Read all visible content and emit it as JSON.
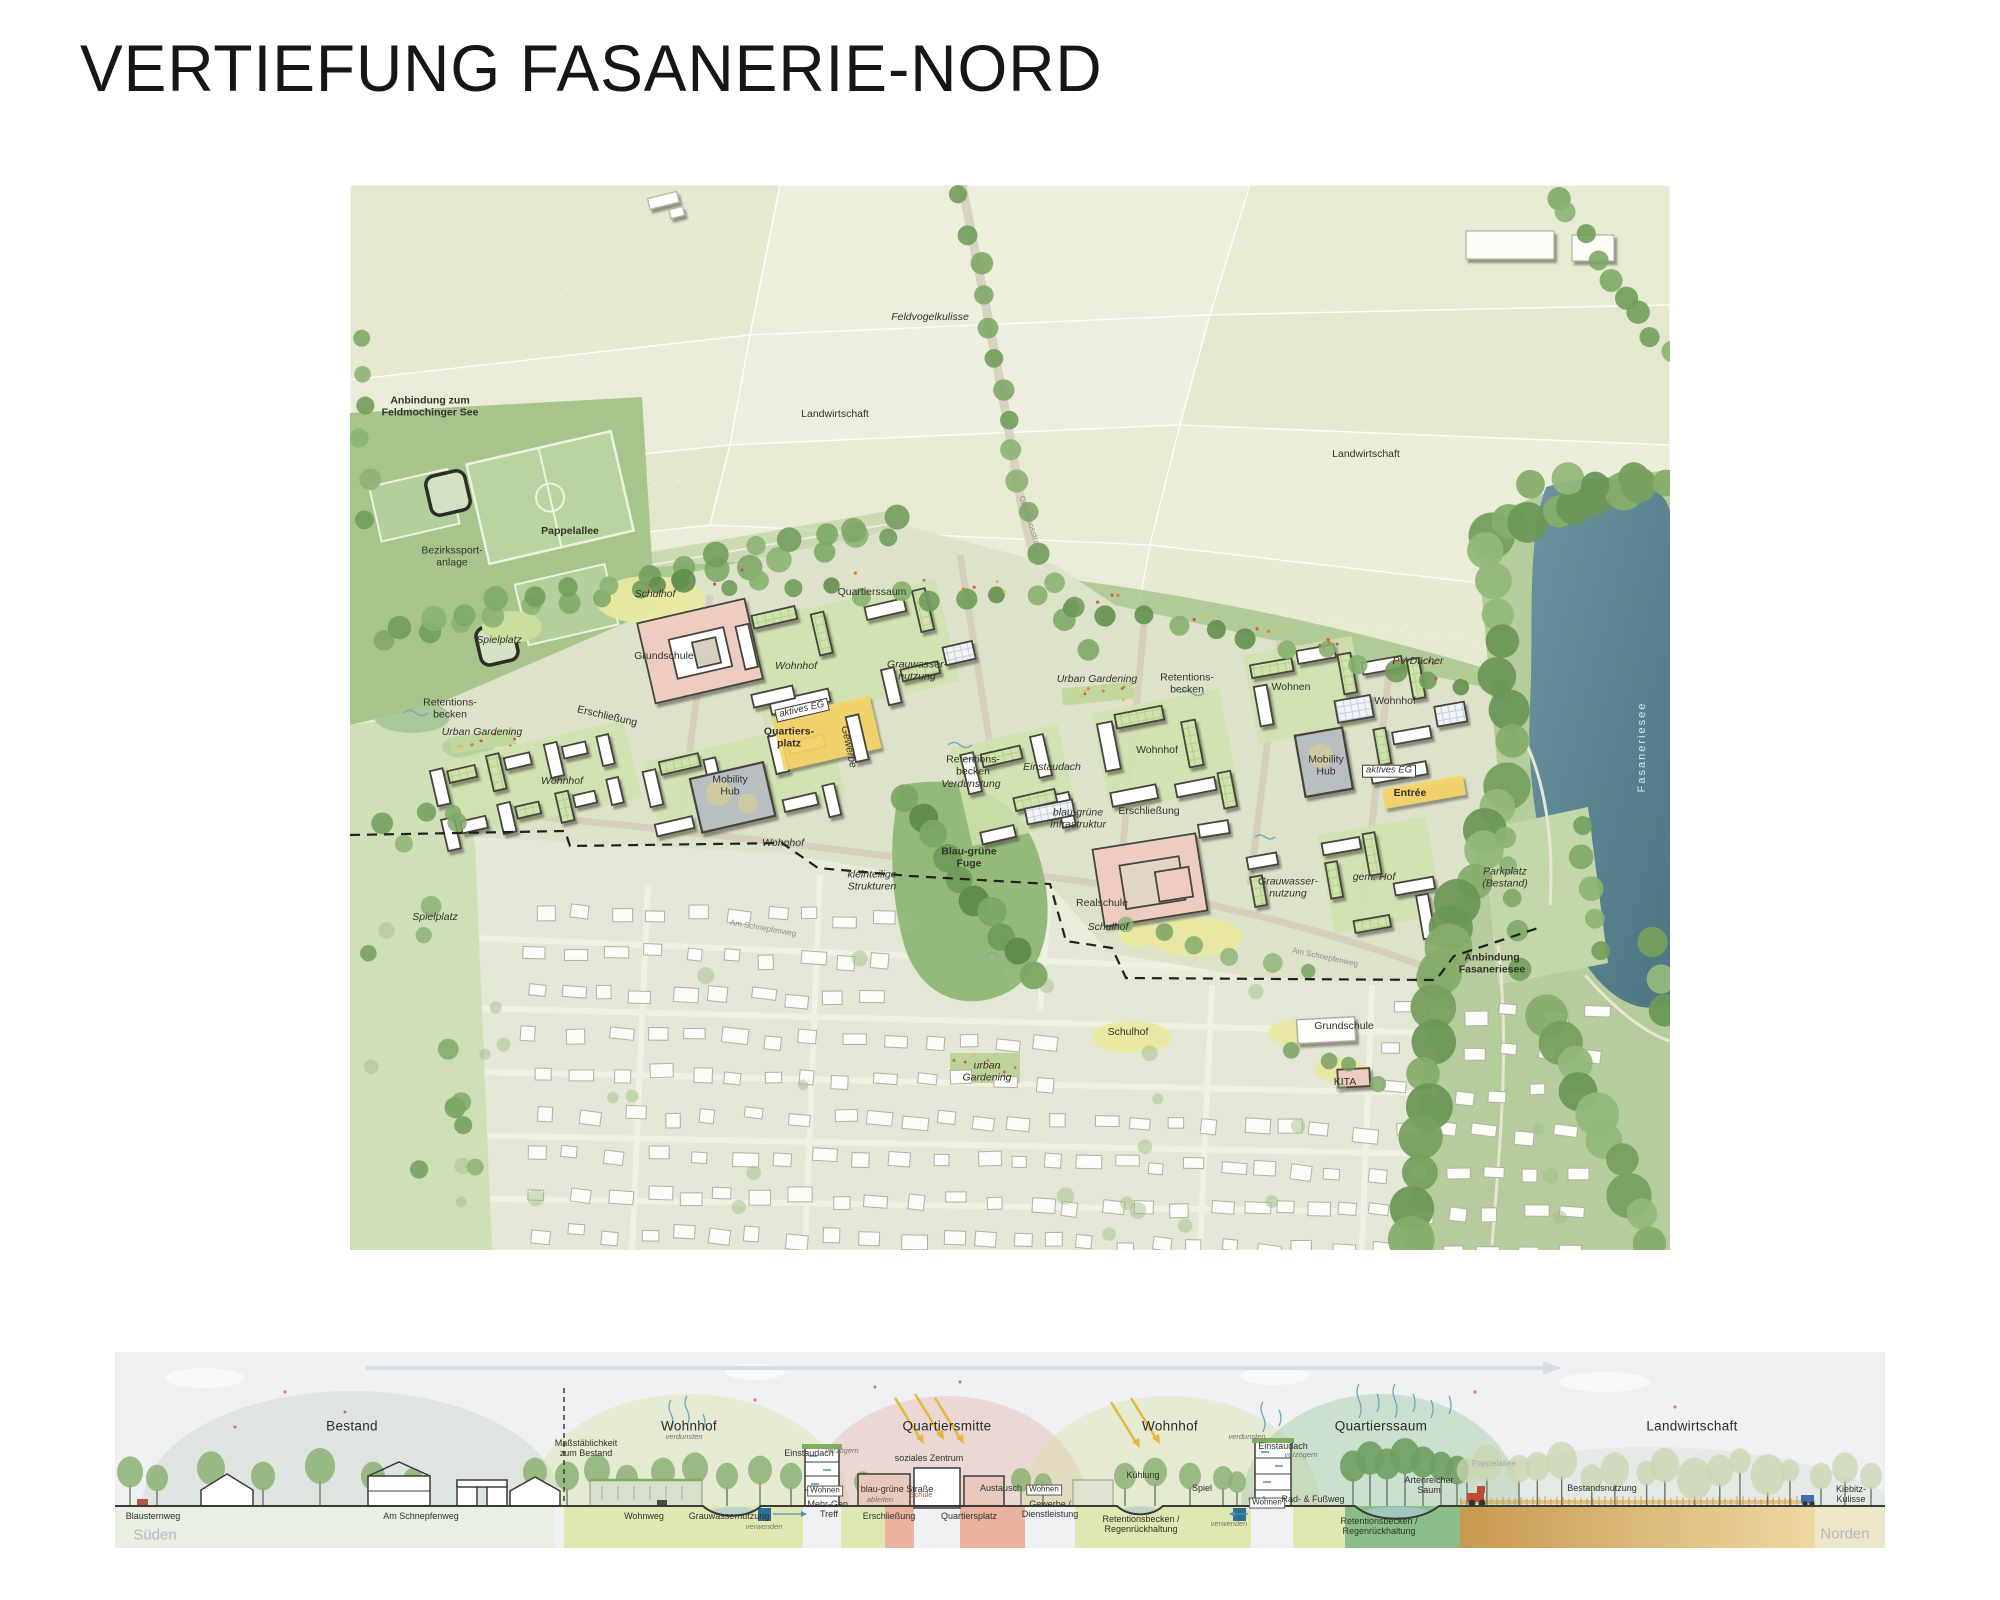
{
  "page": {
    "title": "VERTIEFUNG FASANERIE-NORD"
  },
  "colors": {
    "plaza_yellow": "#f5d469",
    "school_pink": "#efccc1",
    "lake_teal": "#597f8c",
    "mobility_gray": "#b8bfc3",
    "roof_green": "#cfe3ad",
    "field_green": "#e9ecd8",
    "boundary_black": "#21211d"
  },
  "map": {
    "labels": [
      {
        "text": "Anbindung zum\nFeldmochinger See",
        "x": 80,
        "y": 222,
        "cls": "b"
      },
      {
        "text": "Feldvogelkulisse",
        "x": 580,
        "y": 133,
        "cls": "i"
      },
      {
        "text": "Landwirtschaft",
        "x": 485,
        "y": 230
      },
      {
        "text": "Landwirtschaft",
        "x": 1016,
        "y": 270
      },
      {
        "text": "Pappelallee",
        "x": 220,
        "y": 347,
        "cls": "b"
      },
      {
        "text": "Bezirkssport-\nanlage",
        "x": 102,
        "y": 372
      },
      {
        "text": "Schulhof",
        "x": 305,
        "y": 410,
        "cls": "i"
      },
      {
        "text": "Spielplatz",
        "x": 149,
        "y": 456,
        "cls": "i"
      },
      {
        "text": "Grundschule",
        "x": 314,
        "y": 472
      },
      {
        "text": "Retentions-\nbecken",
        "x": 100,
        "y": 524
      },
      {
        "text": "Erschließung",
        "x": 257,
        "y": 532,
        "rot": 13
      },
      {
        "text": "Urban Gardening",
        "x": 132,
        "y": 548,
        "cls": "i"
      },
      {
        "text": "Quartierssaum",
        "x": 522,
        "y": 408
      },
      {
        "text": "Wohnhof",
        "x": 446,
        "y": 482,
        "cls": "i"
      },
      {
        "text": "Grauwasser-\nnutzung",
        "x": 567,
        "y": 486,
        "cls": "i"
      },
      {
        "text": "aktives EG",
        "x": 452,
        "y": 525,
        "cls": "i box",
        "rot": -13
      },
      {
        "text": "Quartiers-\nplatz",
        "x": 439,
        "y": 553,
        "cls": "b"
      },
      {
        "text": "Gewerbe",
        "x": 498,
        "y": 562,
        "cls": "i",
        "rot": 78
      },
      {
        "text": "Retentions-\nbecken",
        "x": 623,
        "y": 581
      },
      {
        "text": "Verdunstung",
        "x": 621,
        "y": 600,
        "cls": "i"
      },
      {
        "text": "Mobility\nHub",
        "x": 380,
        "y": 601
      },
      {
        "text": "Urban Gardening",
        "x": 747,
        "y": 495,
        "cls": "i"
      },
      {
        "text": "Retentions-\nbecken",
        "x": 837,
        "y": 499
      },
      {
        "text": "Wohnen",
        "x": 941,
        "y": 503
      },
      {
        "text": "Einstaudach",
        "x": 702,
        "y": 583,
        "cls": "i"
      },
      {
        "text": "Wohnhof",
        "x": 807,
        "y": 566
      },
      {
        "text": "Mobility\nHub",
        "x": 976,
        "y": 581
      },
      {
        "text": "Wohnhof",
        "x": 1045,
        "y": 517
      },
      {
        "text": "PV-Dächer",
        "x": 1068,
        "y": 477,
        "cls": "i"
      },
      {
        "text": "aktives EG",
        "x": 1039,
        "y": 586,
        "cls": "i box"
      },
      {
        "text": "Entrée",
        "x": 1060,
        "y": 609,
        "cls": "b"
      },
      {
        "text": "blau-grüne\nInfrastruktur",
        "x": 728,
        "y": 634,
        "cls": "i"
      },
      {
        "text": "Erschließung",
        "x": 799,
        "y": 627
      },
      {
        "text": "gem. Hof",
        "x": 1024,
        "y": 693,
        "cls": "i"
      },
      {
        "text": "Grauwasser-\nnutzung",
        "x": 938,
        "y": 703,
        "cls": "i"
      },
      {
        "text": "Parkplatz\n(Bestand)",
        "x": 1155,
        "y": 693,
        "cls": "i"
      },
      {
        "text": "Anbindung\nFasaneriesee",
        "x": 1142,
        "y": 779,
        "cls": "b"
      },
      {
        "text": "Fasaneriesee",
        "x": 1292,
        "y": 562,
        "cls": "lake",
        "rot": -90
      },
      {
        "text": "Realschule",
        "x": 752,
        "y": 719
      },
      {
        "text": "Schulhof",
        "x": 758,
        "y": 743,
        "cls": "i"
      },
      {
        "text": "Blau-grüne\nFuge",
        "x": 619,
        "y": 673,
        "cls": "b"
      },
      {
        "text": "kleinteilige\nStrukturen",
        "x": 522,
        "y": 696,
        "cls": "i"
      },
      {
        "text": "Spielplatz",
        "x": 85,
        "y": 733,
        "cls": "i"
      },
      {
        "text": "Schulhof",
        "x": 778,
        "y": 848
      },
      {
        "text": "Grundschule",
        "x": 994,
        "y": 842
      },
      {
        "text": "KITA",
        "x": 995,
        "y": 898
      },
      {
        "text": "urban\nGardening",
        "x": 637,
        "y": 887,
        "cls": "i"
      },
      {
        "text": "Wohnhof",
        "x": 212,
        "y": 597,
        "cls": "i"
      },
      {
        "text": "Wohnhof",
        "x": 433,
        "y": 659,
        "cls": "i"
      },
      {
        "text": "Obermoosstraße",
        "x": 680,
        "y": 340,
        "cls": "street",
        "rot": 72
      },
      {
        "text": "Am Schnepfenweg",
        "x": 413,
        "y": 744,
        "cls": "street",
        "rot": 10
      },
      {
        "text": "Am Schnepfenweg",
        "x": 975,
        "y": 773,
        "cls": "street",
        "rot": 12
      }
    ]
  },
  "section": {
    "labels": [
      {
        "text": "Bestand",
        "x": 237,
        "y": 74,
        "cls": "h"
      },
      {
        "text": "Wohnhof",
        "x": 574,
        "y": 74,
        "cls": "h"
      },
      {
        "text": "Quartiersmitte",
        "x": 832,
        "y": 74,
        "cls": "h"
      },
      {
        "text": "Wohnhof",
        "x": 1055,
        "y": 74,
        "cls": "h"
      },
      {
        "text": "Quartierssaum",
        "x": 1266,
        "y": 74,
        "cls": "h"
      },
      {
        "text": "Landwirtschaft",
        "x": 1577,
        "y": 74,
        "cls": "h"
      },
      {
        "text": "Maßstäblichkeit\nzum Bestand",
        "x": 471,
        "y": 96,
        "cls": "s"
      },
      {
        "text": "Blausternweg",
        "x": 38,
        "y": 164,
        "cls": "s"
      },
      {
        "text": "Am Schnepfenweg",
        "x": 306,
        "y": 164,
        "cls": "s"
      },
      {
        "text": "Wohnweg",
        "x": 529,
        "y": 164,
        "cls": "s"
      },
      {
        "text": "Grauwassernutzung",
        "x": 614,
        "y": 164,
        "cls": "s"
      },
      {
        "text": "Einstaudach",
        "x": 694,
        "y": 101,
        "cls": "s"
      },
      {
        "text": "Wohnen",
        "x": 710,
        "y": 139,
        "cls": "sbox"
      },
      {
        "text": "Mehr-Gen.\nTreff",
        "x": 714,
        "y": 157,
        "cls": "s"
      },
      {
        "text": "blau-grüne Straße",
        "x": 782,
        "y": 137,
        "cls": "s"
      },
      {
        "text": "soziales Zentrum",
        "x": 814,
        "y": 106,
        "cls": "s"
      },
      {
        "text": "Schule",
        "x": 806,
        "y": 143,
        "cls": "red"
      },
      {
        "text": "Erschließung",
        "x": 774,
        "y": 164,
        "cls": "s"
      },
      {
        "text": "Quartiersplatz",
        "x": 854,
        "y": 164,
        "cls": "s"
      },
      {
        "text": "Austausch",
        "x": 886,
        "y": 136,
        "cls": "s"
      },
      {
        "text": "Wohnen",
        "x": 929,
        "y": 138,
        "cls": "sbox"
      },
      {
        "text": "Gewerbe /\nDienstleistung",
        "x": 935,
        "y": 157,
        "cls": "s"
      },
      {
        "text": "Kühlung",
        "x": 1028,
        "y": 123,
        "cls": "s"
      },
      {
        "text": "Spiel",
        "x": 1087,
        "y": 136,
        "cls": "s"
      },
      {
        "text": "Retentionsbecken /\nRegenrückhaltung",
        "x": 1026,
        "y": 172,
        "cls": "s"
      },
      {
        "text": "Einstaudach",
        "x": 1168,
        "y": 94,
        "cls": "s"
      },
      {
        "text": "Wohnen",
        "x": 1152,
        "y": 151,
        "cls": "sbox"
      },
      {
        "text": "Rad- & Fußweg",
        "x": 1198,
        "y": 147,
        "cls": "s"
      },
      {
        "text": "Artenreicher\nSaum",
        "x": 1314,
        "y": 133,
        "cls": "s"
      },
      {
        "text": "Retentionsbecken /\nRegenrückhaltung",
        "x": 1264,
        "y": 174,
        "cls": "s"
      },
      {
        "text": "Bestandsnutzung",
        "x": 1487,
        "y": 136,
        "cls": "s"
      },
      {
        "text": "Kiebitz-Kulisse",
        "x": 1736,
        "y": 142,
        "cls": "s"
      },
      {
        "text": "verdunsten",
        "x": 569,
        "y": 85,
        "cls": "t"
      },
      {
        "text": "verzögern",
        "x": 727,
        "y": 99,
        "cls": "t"
      },
      {
        "text": "verwenden",
        "x": 649,
        "y": 175,
        "cls": "t"
      },
      {
        "text": "ableiten",
        "x": 765,
        "y": 148,
        "cls": "t"
      },
      {
        "text": "verdunsten",
        "x": 1132,
        "y": 85,
        "cls": "t"
      },
      {
        "text": "verzögern",
        "x": 1186,
        "y": 103,
        "cls": "t"
      },
      {
        "text": "verwenden",
        "x": 1114,
        "y": 172,
        "cls": "t"
      },
      {
        "text": "Pappelallee",
        "x": 1379,
        "y": 112,
        "cls": "t2"
      },
      {
        "text": "Süden",
        "x": 40,
        "y": 184,
        "cls": "corner"
      },
      {
        "text": "Norden",
        "x": 1730,
        "y": 183,
        "cls": "corner"
      }
    ]
  }
}
